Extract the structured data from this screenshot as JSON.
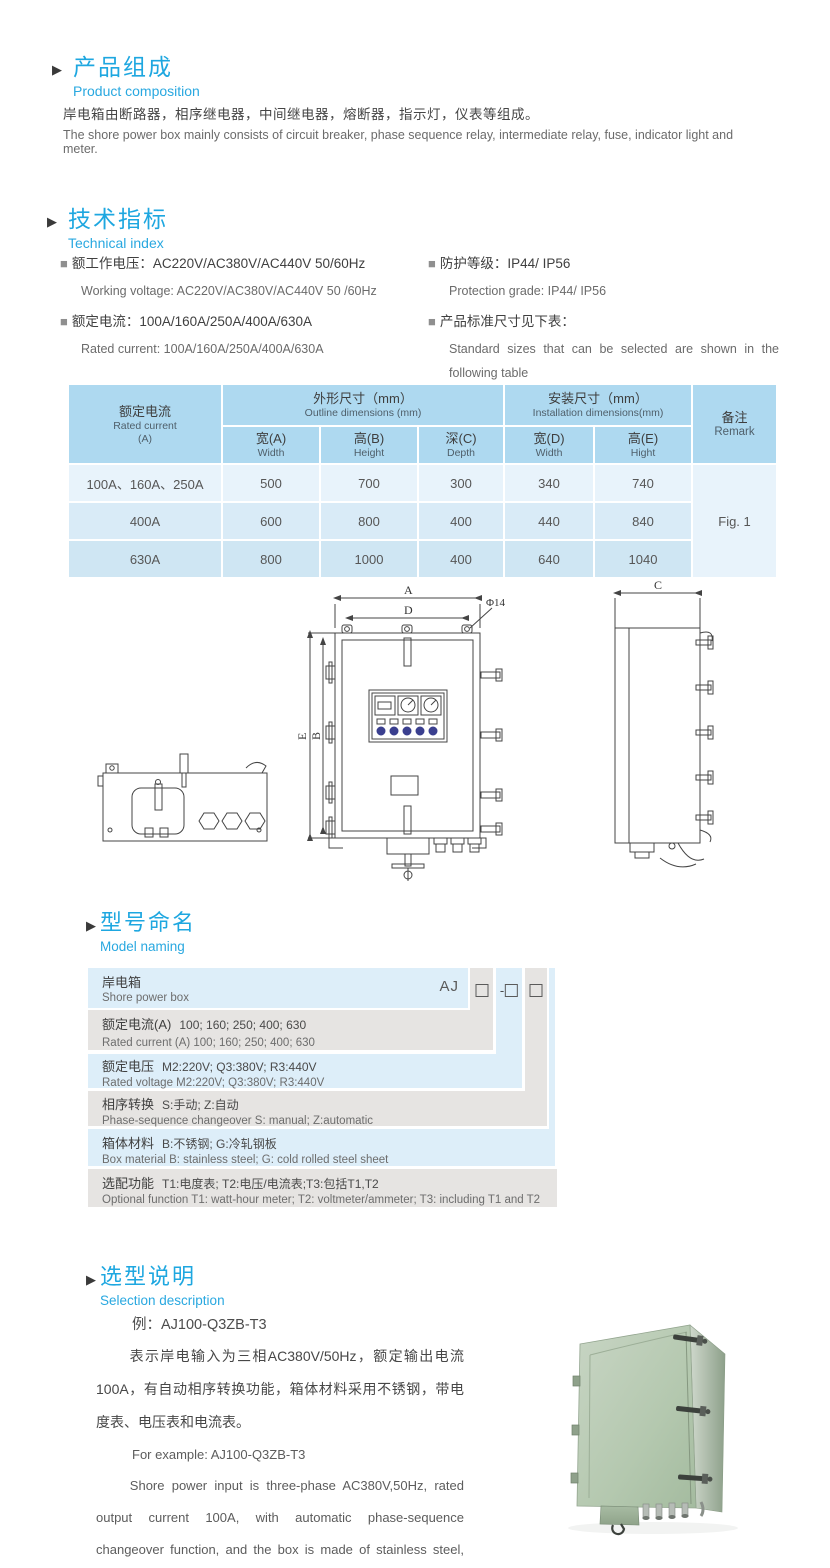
{
  "colors": {
    "accent_blue": "#29a8e0",
    "table_header_bg": "#aed9f0",
    "model_row_blue": "#ddeef9",
    "model_row_gray": "#e6e4e2",
    "photo_green": "#b7cab3"
  },
  "composition": {
    "bullet": "▶",
    "title_cn": "产品组成",
    "title_en": "Product  composition",
    "body_cn": "岸电箱由断路器，相序继电器，中间继电器，熔断器，指示灯，仪表等组成。",
    "body_en": "The shore power box mainly consists of circuit breaker, phase sequence relay, intermediate relay, fuse, indicator light and meter."
  },
  "technical": {
    "bullet": "▶",
    "title_cn": "技术指标",
    "title_en": "Technical index",
    "specs": [
      {
        "bullet": "■",
        "cn": "额工作电压：AC220V/AC380V/AC440V  50/60Hz",
        "en": "Working voltage: AC220V/AC380V/AC440V 50 /60Hz"
      },
      {
        "bullet": "■",
        "cn": "额定电流：100A/160A/250A/400A/630A",
        "en": "Rated current: 100A/160A/250A/400A/630A"
      },
      {
        "bullet": "■",
        "cn": "防护等级：IP44/ IP56",
        "en": "Protection grade: IP44/ IP56"
      },
      {
        "bullet": "■",
        "cn": "产品标准尺寸见下表：",
        "en": "Standard sizes that can be selected are shown in the following table"
      }
    ]
  },
  "size_table": {
    "rated_current_cn": "额定电流",
    "rated_current_en": "Rated current",
    "rated_current_unit": "(A)",
    "outline_cn": "外形尺寸（mm）",
    "outline_en": "Outline dimensions (mm)",
    "install_cn": "安装尺寸（mm）",
    "install_en": "Installation dimensions(mm)",
    "remark_cn": "备注",
    "remark_en": "Remark",
    "sub_headers": [
      {
        "cn": "宽(A)",
        "en": "Width"
      },
      {
        "cn": "高(B)",
        "en": "Height"
      },
      {
        "cn": "深(C)",
        "en": "Depth"
      },
      {
        "cn": "宽(D)",
        "en": "Width"
      },
      {
        "cn": "高(E)",
        "en": "Hight"
      }
    ],
    "rows": [
      {
        "current": "100A、160A、250A",
        "values": [
          "500",
          "700",
          "300",
          "340",
          "740"
        ]
      },
      {
        "current": "400A",
        "values": [
          "600",
          "800",
          "400",
          "440",
          "840"
        ]
      },
      {
        "current": "630A",
        "values": [
          "800",
          "1000",
          "400",
          "640",
          "1040"
        ]
      }
    ],
    "remark_value": "Fig. 1"
  },
  "drawing": {
    "labels": {
      "a": "A",
      "d": "D",
      "phi": "Φ14",
      "e": "E",
      "b": "B",
      "c": "C"
    }
  },
  "model": {
    "bullet": "▶",
    "title_cn": "型号命名",
    "title_en": "Model naming",
    "prefix": "AJ",
    "dash": "-",
    "rows": [
      {
        "label_cn": "岸电箱",
        "value_cn": "",
        "en": "Shore power box"
      },
      {
        "label_cn": "额定电流(A)",
        "value_cn": "100; 160; 250; 400; 630",
        "en": "Rated current (A) 100; 160; 250; 400; 630"
      },
      {
        "label_cn": "额定电压",
        "value_cn": "M2:220V;  Q3:380V;  R3:440V",
        "en": "Rated voltage  M2:220V;  Q3:380V;  R3:440V"
      },
      {
        "label_cn": "相序转换",
        "value_cn": "S:手动; Z:自动",
        "en": "Phase-sequence changeover  S: manual;  Z:automatic"
      },
      {
        "label_cn": "箱体材料",
        "value_cn": "B:不锈钢;  G:冷轧钢板",
        "en": "Box material    B: stainless steel; G: cold rolled steel sheet"
      },
      {
        "label_cn": "选配功能",
        "value_cn": "T1:电度表;  T2:电压/电流表;T3:包括T1,T2",
        "en": "Optional function  T1: watt-hour meter; T2: voltmeter/ammeter; T3: including T1 and T2"
      }
    ]
  },
  "selection": {
    "bullet": "▶",
    "title_cn": "选型说明",
    "title_en": "Selection description",
    "example_cn": "例：AJ100-Q3ZB-T3",
    "body_cn": "表示岸电输入为三相AC380V/50Hz，额定输出电流100A，有自动相序转换功能，箱体材料采用不锈钢，带电度表、电压表和电流表。",
    "example_en": "For example: AJ100-Q3ZB-T3",
    "body_en": "Shore power input is three-phase AC380V,50Hz, rated output current 100A, with automatic phase-sequence changeover function, and the box is made of stainless steel, with watt-hour meter, voltmeter and ammeter."
  }
}
